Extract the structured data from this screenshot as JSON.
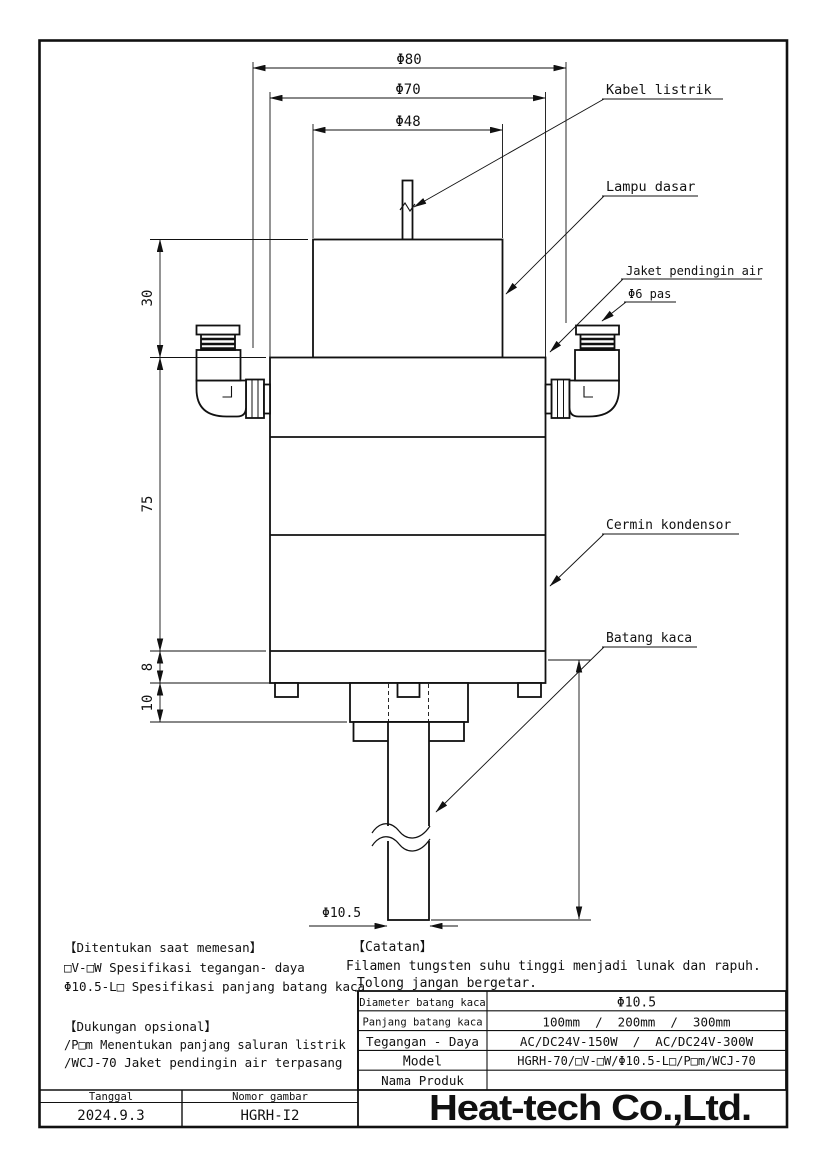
{
  "drawing": {
    "dims": {
      "d80": "Φ80",
      "d70": "Φ70",
      "d48": "Φ48",
      "h30": "30",
      "h75": "75",
      "h8": "8",
      "h10": "10",
      "rod": "Φ10.5"
    },
    "labels": {
      "kabel": "Kabel listrik",
      "lampu": "Lampu dasar",
      "jaket": "Jaket pendingin air",
      "phi6": "Φ6 pas",
      "cermin": "Cermin kondensor",
      "batang": "Batang kaca"
    }
  },
  "notes": {
    "order": {
      "title": "【Ditentukan saat memesan】",
      "lines": [
        "□V-□W Spesifikasi tegangan- daya",
        "Φ10.5-L□ Spesifikasi panjang batang kaca"
      ]
    },
    "optional": {
      "title": "【Dukungan opsional】",
      "lines": [
        "/P□m Menentukan panjang saluran listrik",
        "/WCJ-70 Jaket pendingin air terpasang"
      ]
    },
    "caution": {
      "title": "【Catatan】",
      "lines": [
        "Filamen tungsten suhu tinggi menjadi lunak dan rapuh.",
        "Tolong jangan bergetar."
      ]
    }
  },
  "spec_table": {
    "rows": [
      {
        "label": "Diameter batang kaca",
        "value": "Φ10.5"
      },
      {
        "label": "Panjang batang kaca",
        "value": "100mm  /  200mm  /  300mm"
      },
      {
        "label": "Tegangan - Daya",
        "value": "AC/DC24V-150W  /  AC/DC24V-300W"
      },
      {
        "label": "Model",
        "value": "HGRH-70/□V-□W/Φ10.5-L□/P□m/WCJ-70"
      },
      {
        "label": "Nama Produk",
        "value": ""
      }
    ]
  },
  "title_block": {
    "date_label": "Tanggal",
    "date_value": "2024.9.3",
    "number_label": "Nomor gambar",
    "number_value": "HGRH-I2"
  },
  "logo": {
    "text": "Heat-tech Co.,Ltd.",
    "color": "#ee0000"
  }
}
